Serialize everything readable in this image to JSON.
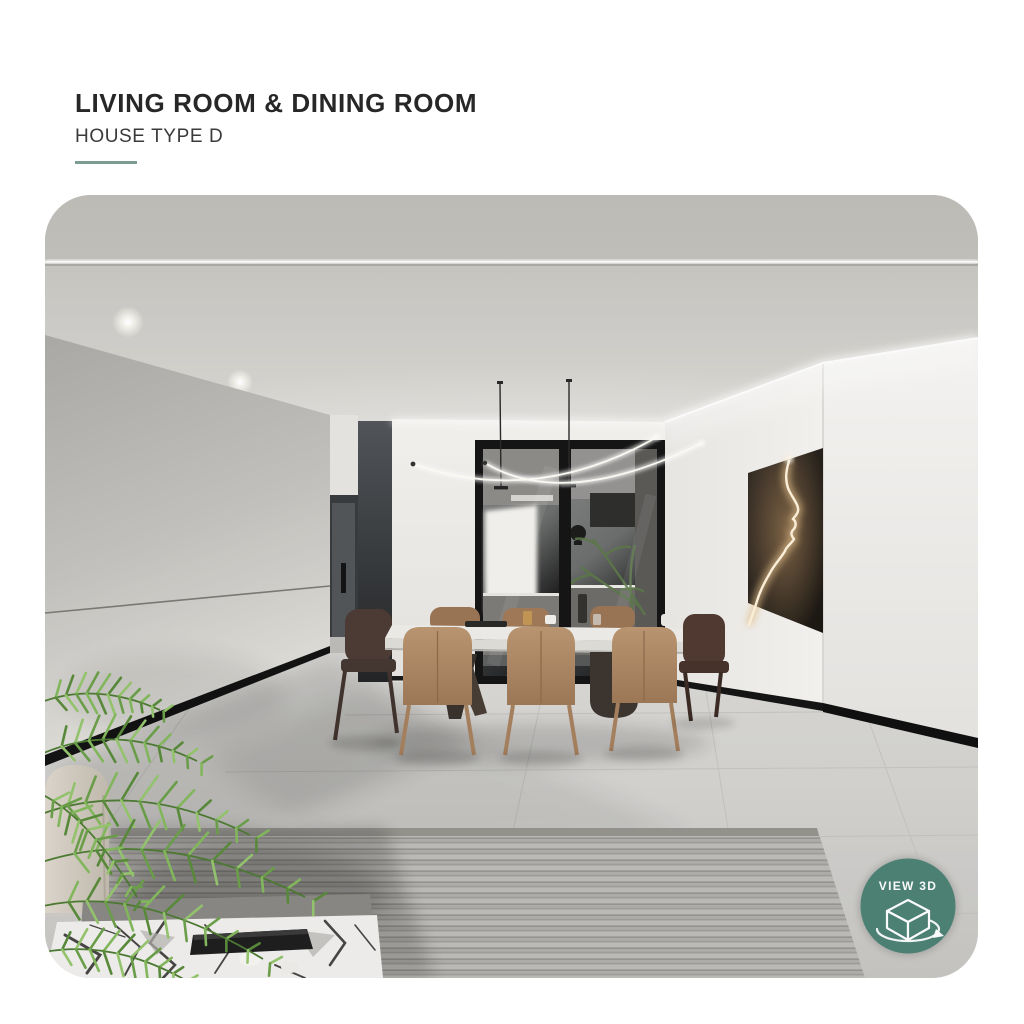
{
  "header": {
    "title": "LIVING ROOM & DINING ROOM",
    "subtitle": "HOUSE TYPE D"
  },
  "viewer": {
    "badge_label": "VIEW 3D"
  },
  "theme": {
    "page_background": "#ffffff",
    "title_color": "#272727",
    "subtitle_color": "#3a3a3a",
    "accent_underline": "#7c9e91",
    "badge_color": "#4d8376",
    "badge_text_color": "#ffffff"
  }
}
